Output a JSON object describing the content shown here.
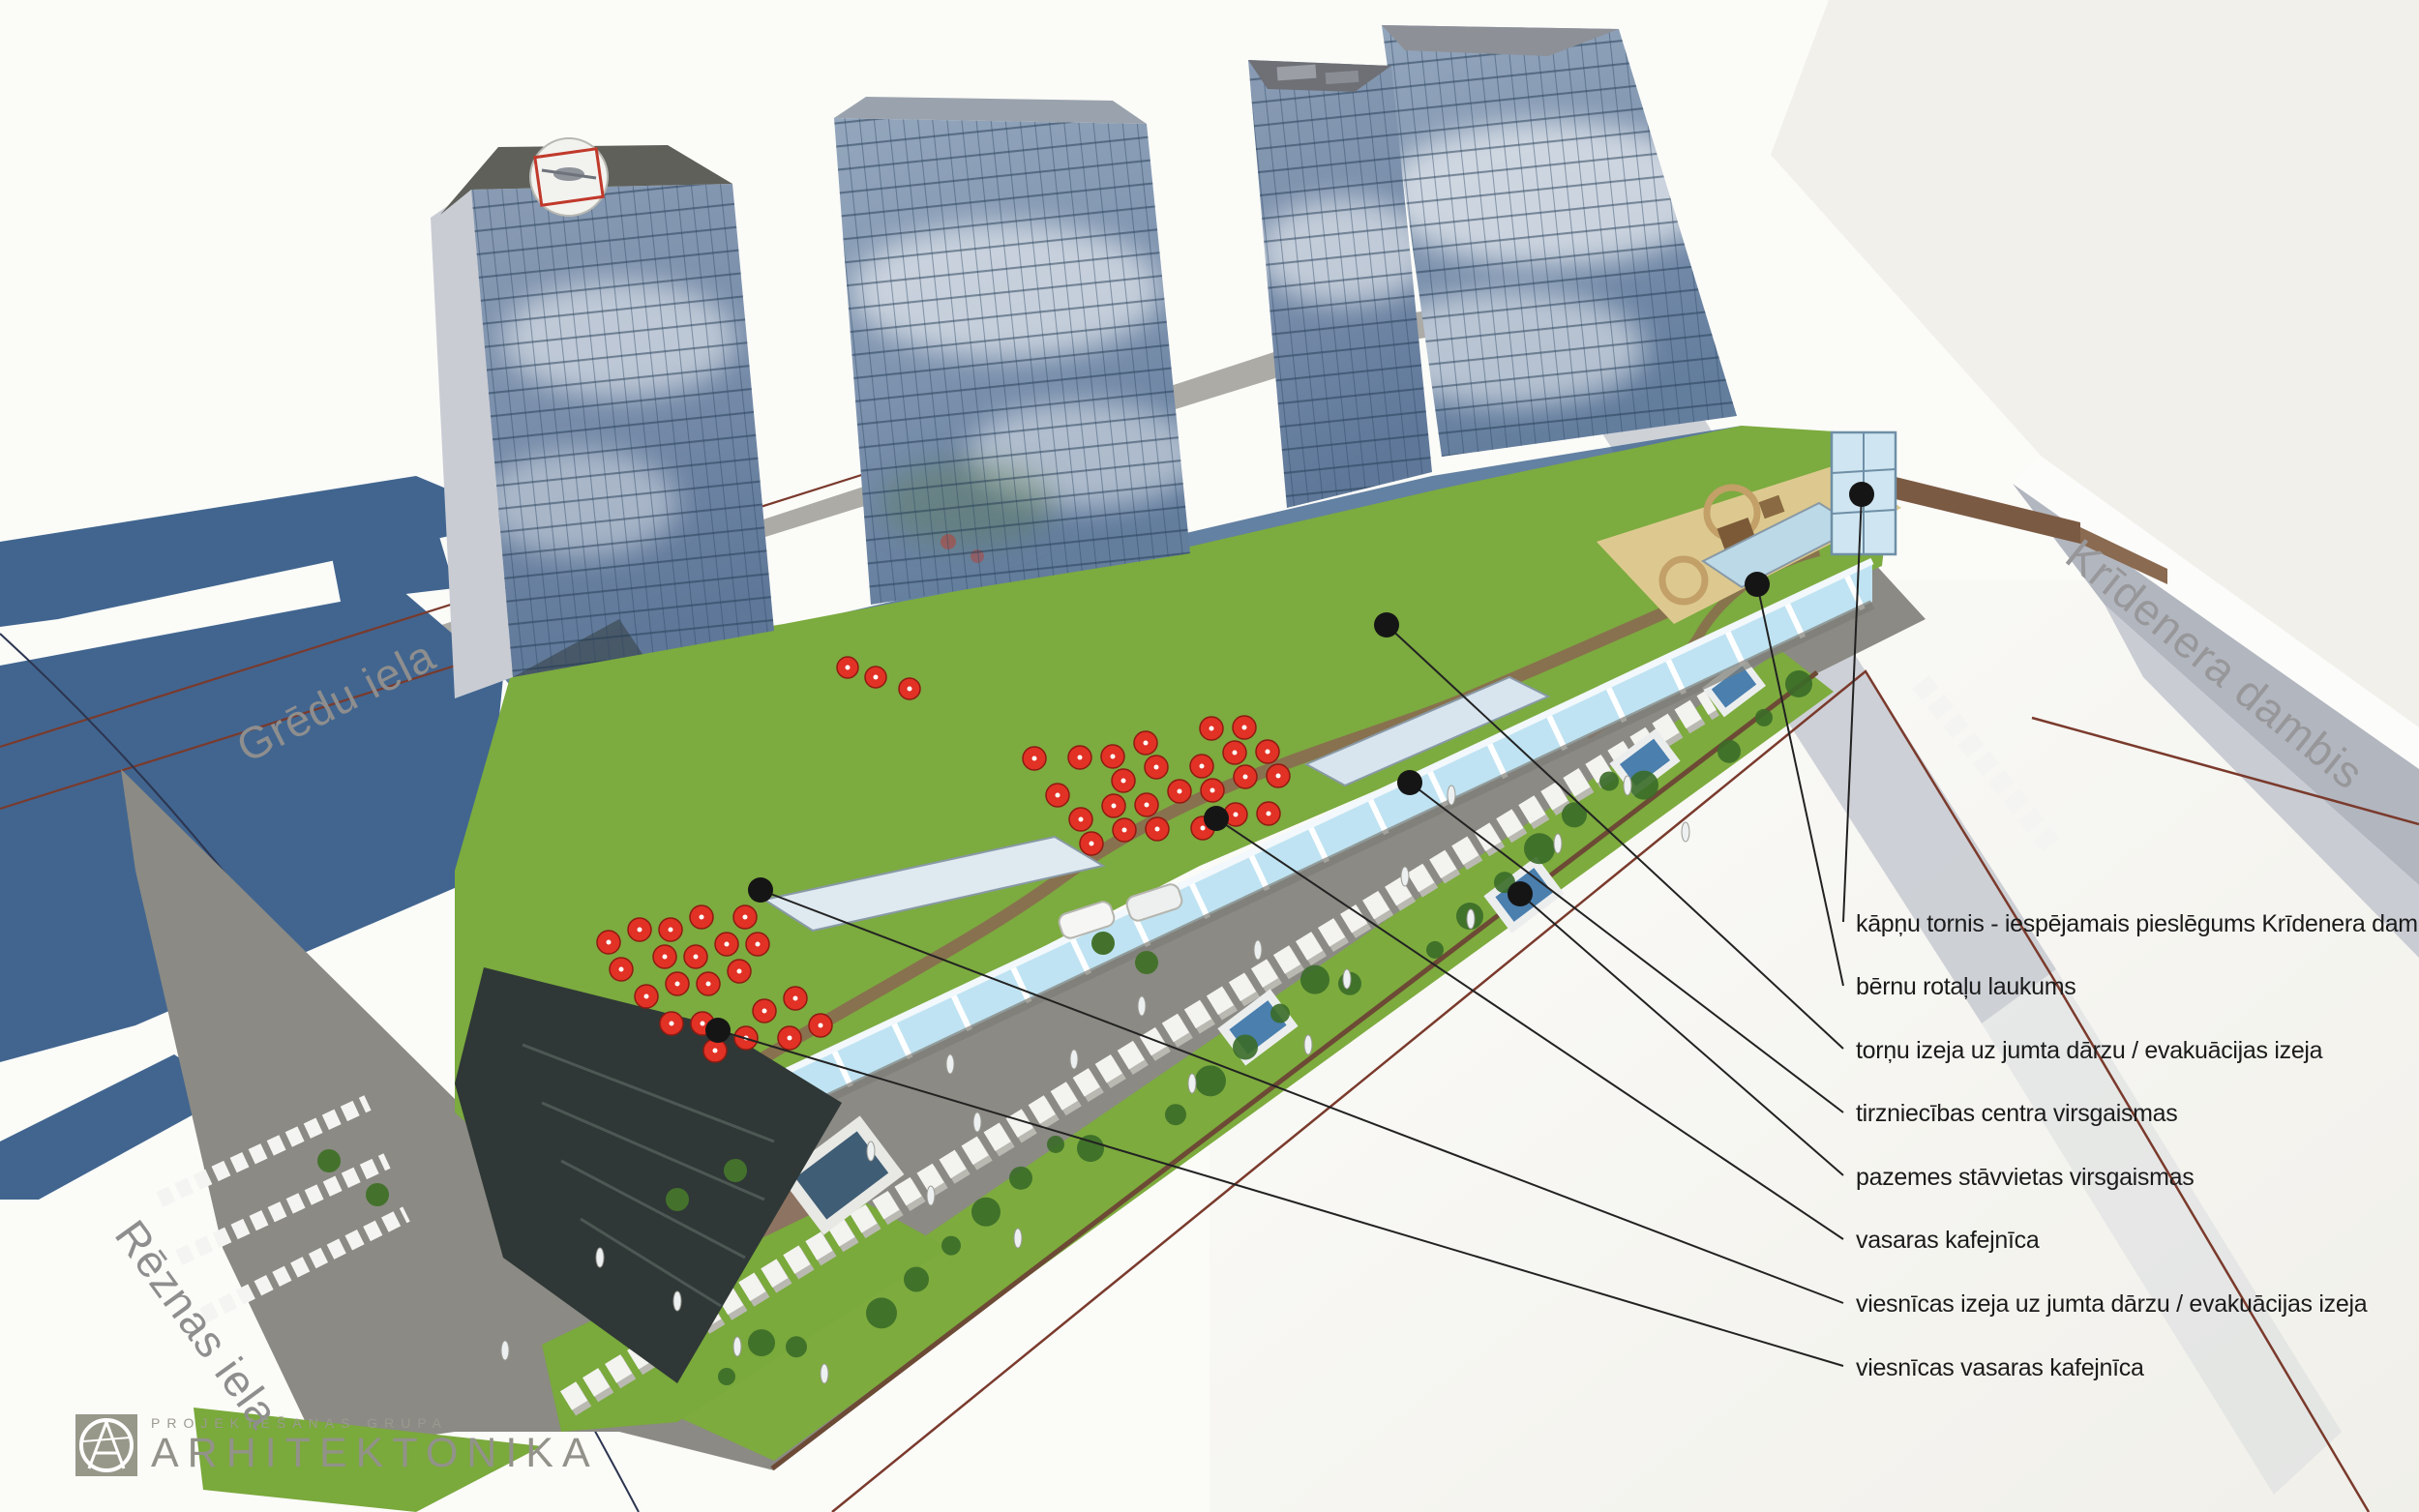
{
  "annotations": {
    "items": [
      {
        "label": "kāpņu tornis - iespējamais pieslēgums Krīdenera dambim"
      },
      {
        "label": "bērnu rotaļu laukums"
      },
      {
        "label": "torņu izeja uz jumta dārzu / evakuācijas izeja"
      },
      {
        "label": "tirzniecības centra virsgaismas"
      },
      {
        "label": "pazemes stāvvietas virsgaismas"
      },
      {
        "label": "vasaras kafejnīca"
      },
      {
        "label": "viesnīcas izeja uz jumta dārzu / evakuācijas izeja"
      },
      {
        "label": "viesnīcas vasaras kafejnīca"
      }
    ]
  },
  "streets": {
    "gredu": "Grēdu iela",
    "reznas": "Rēznas iela",
    "kridenera": "Krīdenera dambis"
  },
  "logo": {
    "group": "PROJEKTĒŠANAS GRUPA",
    "name": "ARHITEKTONIKA"
  },
  "colors": {
    "umbrella_red": "#e23125",
    "shadow_blue": "#41658f",
    "glass_blue": "#7b90ac",
    "lawn_green": "#7dab3e",
    "podium_glass": "#b5e0f1",
    "boundary_red": "#7a3a2c",
    "label_text": "#1b1b1b"
  }
}
